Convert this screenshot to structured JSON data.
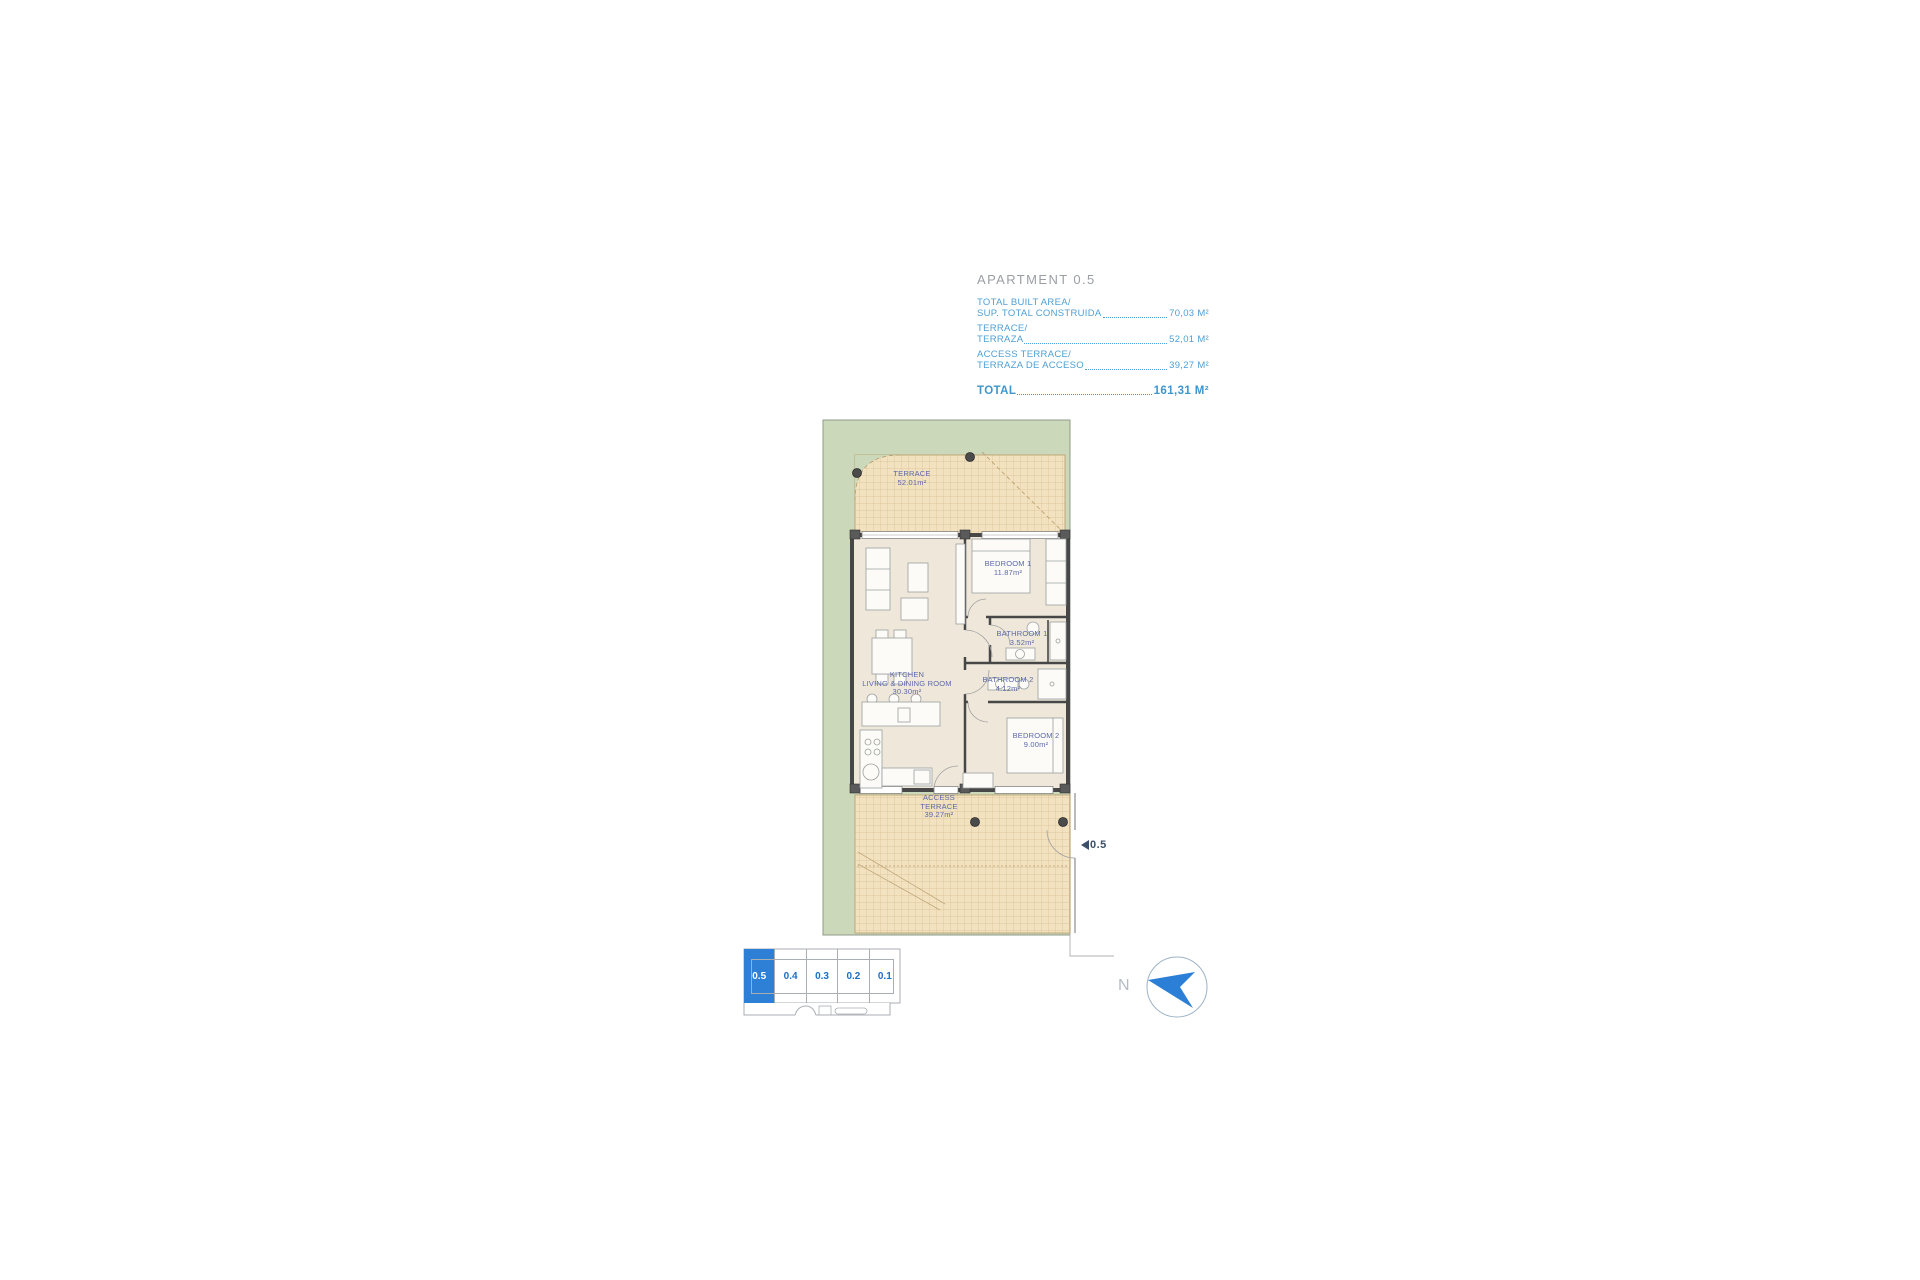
{
  "header": {
    "title": "APARTMENT 0.5",
    "rows": [
      {
        "label_en": "TOTAL BUILT AREA/",
        "label_es": "SUP. TOTAL CONSTRUIDA",
        "value": "70,03 M²"
      },
      {
        "label_en": "TERRACE/",
        "label_es": "TERRAZA",
        "value": "52,01 M²"
      },
      {
        "label_en": "ACCESS TERRACE/",
        "label_es": "TERRAZA DE ACCESO",
        "value": "39,27 M²"
      }
    ],
    "total_label": "TOTAL",
    "total_value": "161,31 M²"
  },
  "plan": {
    "rooms": {
      "terrace": {
        "line1": "TERRACE",
        "area": "52.01m²"
      },
      "kitchen_living": {
        "line1": "KITCHEN",
        "line2": "LIVING & DINING ROOM",
        "area": "30.30m²"
      },
      "bedroom1": {
        "line1": "BEDROOM 1",
        "area": "11.87m²"
      },
      "bathroom1": {
        "line1": "BATHROOM 1",
        "area": "3.52m²"
      },
      "bathroom2": {
        "line1": "BATHROOM 2",
        "area": "4.12m²"
      },
      "bedroom2": {
        "line1": "BEDROOM 2",
        "area": "9.00m²"
      },
      "access_terrace": {
        "line1": "ACCESS",
        "line2": "TERRACE",
        "area": "39.27m²"
      }
    },
    "unit_marker": "0.5"
  },
  "key_plan": {
    "units": [
      {
        "label": "0.5",
        "highlighted": true
      },
      {
        "label": "0.4",
        "highlighted": false
      },
      {
        "label": "0.3",
        "highlighted": false
      },
      {
        "label": "0.2",
        "highlighted": false
      },
      {
        "label": "0.1",
        "highlighted": false
      }
    ]
  },
  "compass": {
    "north_label": "N"
  },
  "colors": {
    "accent_blue": "#2e7fd6",
    "summary_blue": "#4f9fd4",
    "room_label_blue": "#5b68ab",
    "garden_green": "#ccd8ba",
    "terrace_tan": "#f2e2c0",
    "floor_cream": "#efe8da",
    "wall_gray": "#474747"
  }
}
